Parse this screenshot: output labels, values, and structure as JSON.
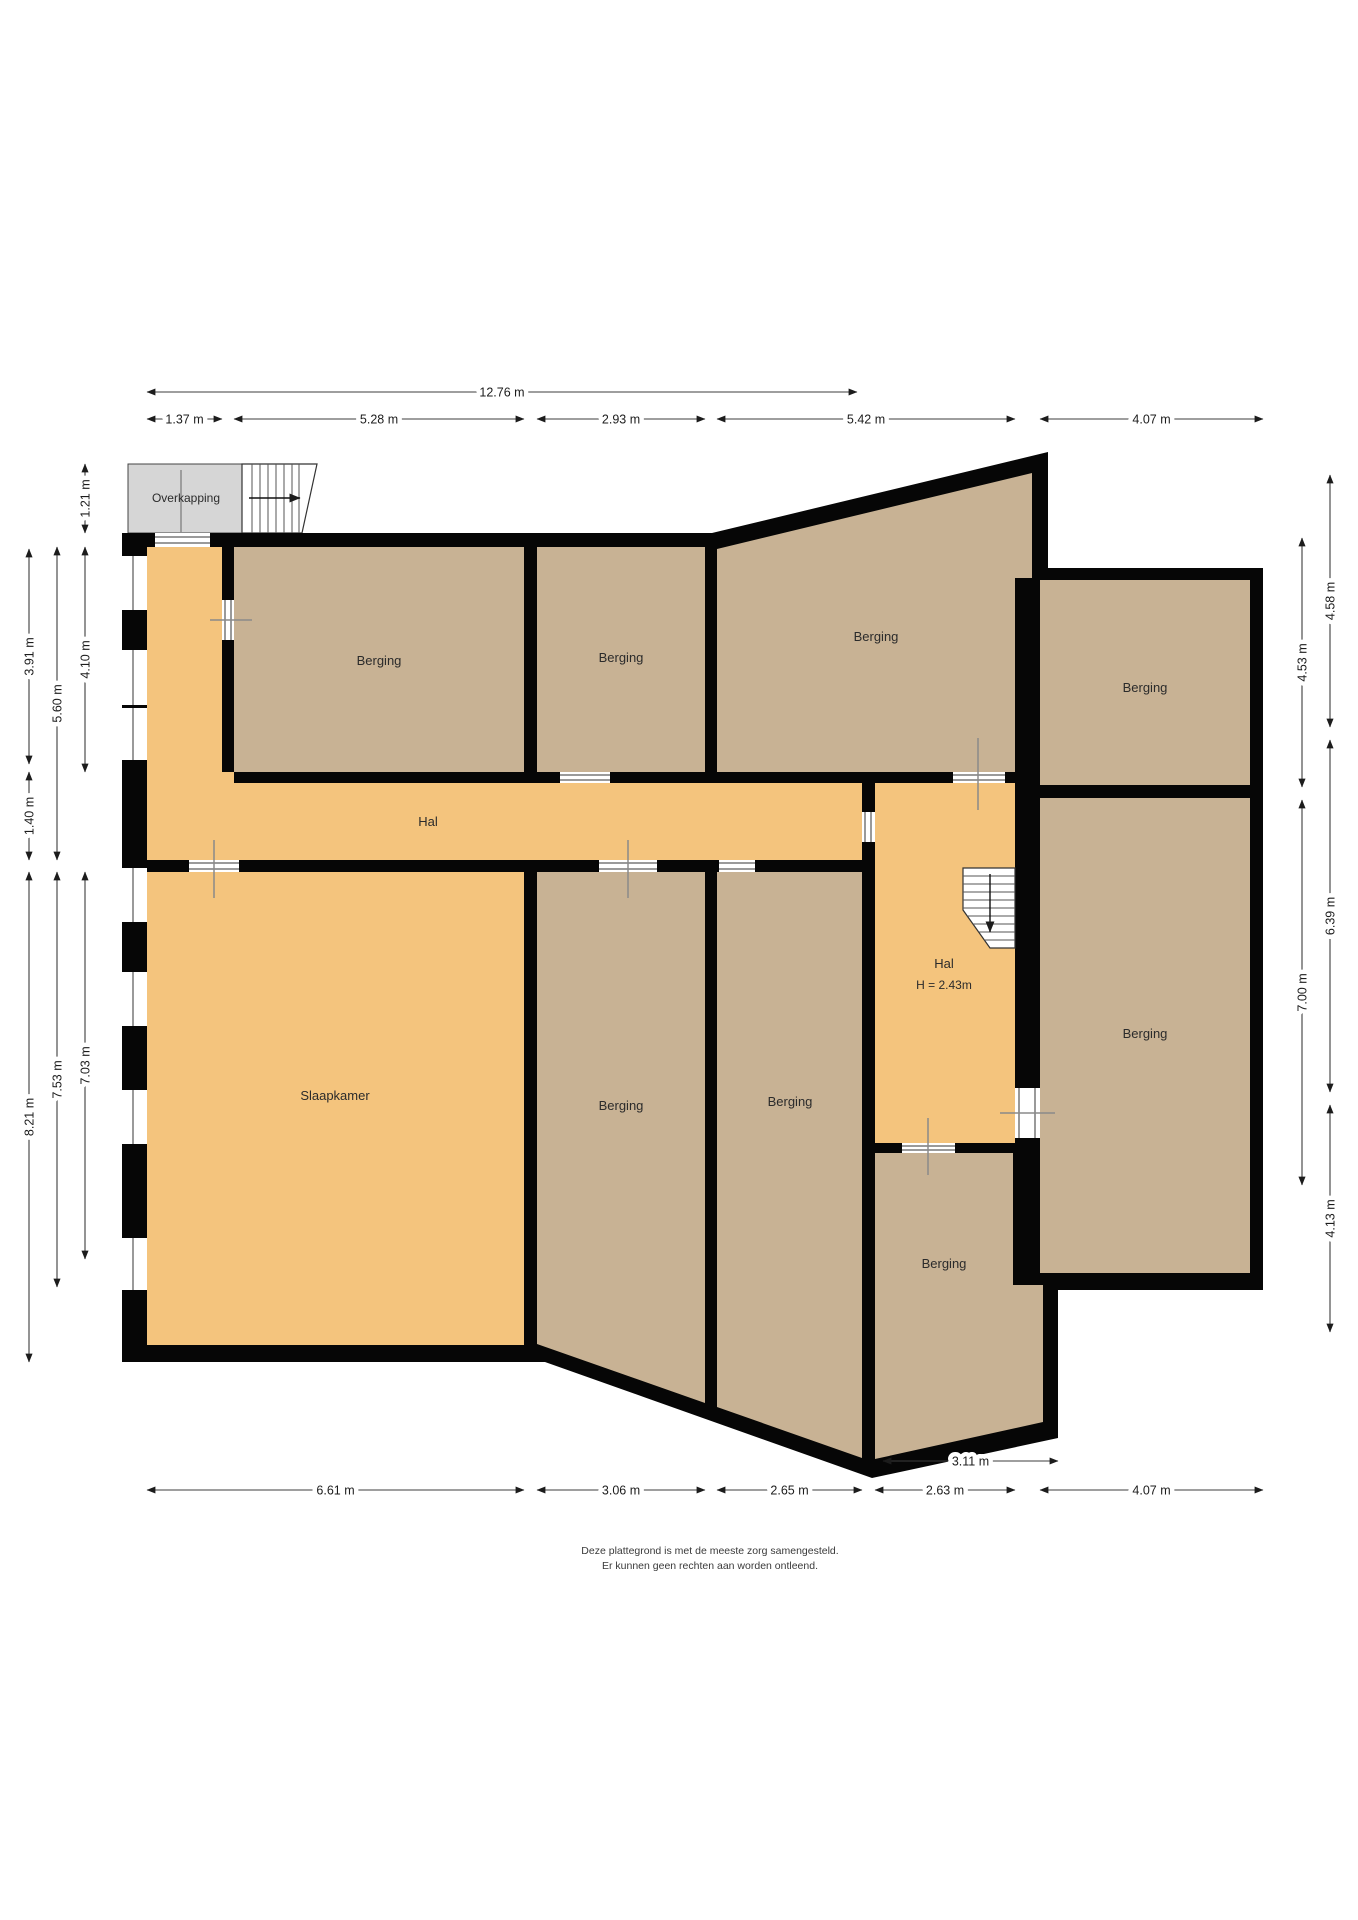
{
  "colors": {
    "wall": "#060606",
    "room_storage": "#c8b294",
    "room_hall": "#f4c47d",
    "canopy": "#d6d6d6",
    "dimension_text": "#1c1c1c"
  },
  "rooms": [
    {
      "id": "overkapping",
      "label": "Overkapping",
      "x": 186,
      "y": 502,
      "small": true
    },
    {
      "id": "berging-top-left",
      "label": "Berging",
      "x": 379,
      "y": 665
    },
    {
      "id": "berging-top-middle",
      "label": "Berging",
      "x": 621,
      "y": 662
    },
    {
      "id": "berging-top-right",
      "label": "Berging",
      "x": 876,
      "y": 641
    },
    {
      "id": "hal-corridor",
      "label": "Hal",
      "x": 428,
      "y": 826
    },
    {
      "id": "berging-wing-top",
      "label": "Berging",
      "x": 1145,
      "y": 692
    },
    {
      "id": "berging-wing-bottom",
      "label": "Berging",
      "x": 1145,
      "y": 1038
    },
    {
      "id": "hal-inner",
      "label": "Hal",
      "x": 944,
      "y": 968
    },
    {
      "id": "hal-inner-height",
      "label": "H = 2.43m",
      "x": 944,
      "y": 989,
      "small": true
    },
    {
      "id": "slaapkamer",
      "label": "Slaapkamer",
      "x": 335,
      "y": 1100
    },
    {
      "id": "berging-bottom-1",
      "label": "Berging",
      "x": 621,
      "y": 1110
    },
    {
      "id": "berging-bottom-2",
      "label": "Berging",
      "x": 790,
      "y": 1106
    },
    {
      "id": "berging-bottom-right",
      "label": "Berging",
      "x": 944,
      "y": 1268
    }
  ],
  "dimensions": {
    "top": [
      {
        "label": "12.76 m",
        "x1": 147,
        "x2": 857,
        "y": 392
      },
      {
        "label": "1.37 m",
        "x1": 147,
        "x2": 222,
        "y": 419
      },
      {
        "label": "5.28 m",
        "x1": 234,
        "x2": 524,
        "y": 419
      },
      {
        "label": "2.93 m",
        "x1": 537,
        "x2": 705,
        "y": 419
      },
      {
        "label": "5.42 m",
        "x1": 717,
        "x2": 1015,
        "y": 419
      },
      {
        "label": "4.07 m",
        "x1": 1040,
        "x2": 1263,
        "y": 419
      }
    ],
    "bottom": [
      {
        "label": "3.11 m",
        "x1": 883,
        "x2": 1058,
        "y": 1461
      },
      {
        "label": "6.61 m",
        "x1": 147,
        "x2": 524,
        "y": 1490
      },
      {
        "label": "3.06 m",
        "x1": 537,
        "x2": 705,
        "y": 1490
      },
      {
        "label": "2.65 m",
        "x1": 717,
        "x2": 862,
        "y": 1490
      },
      {
        "label": "2.63 m",
        "x1": 875,
        "x2": 1015,
        "y": 1490
      },
      {
        "label": "4.07 m",
        "x1": 1040,
        "x2": 1263,
        "y": 1490
      }
    ],
    "left": [
      {
        "label": "3.91 m",
        "y1": 549,
        "y2": 764,
        "x": 29
      },
      {
        "label": "1.40 m",
        "y1": 772,
        "y2": 860,
        "x": 29
      },
      {
        "label": "8.21 m",
        "y1": 872,
        "y2": 1362,
        "x": 29
      },
      {
        "label": "5.60 m",
        "y1": 547,
        "y2": 860,
        "x": 57
      },
      {
        "label": "7.53 m",
        "y1": 872,
        "y2": 1287,
        "x": 57
      },
      {
        "label": "1.21 m",
        "y1": 464,
        "y2": 533,
        "x": 85
      },
      {
        "label": "4.10 m",
        "y1": 547,
        "y2": 772,
        "x": 85
      },
      {
        "label": "7.03 m",
        "y1": 872,
        "y2": 1259,
        "x": 85
      }
    ],
    "right": [
      {
        "label": "4.58 m",
        "y1": 475,
        "y2": 727,
        "x": 1330
      },
      {
        "label": "6.39 m",
        "y1": 740,
        "y2": 1092,
        "x": 1330
      },
      {
        "label": "4.13 m",
        "y1": 1105,
        "y2": 1332,
        "x": 1330
      },
      {
        "label": "4.53 m",
        "y1": 538,
        "y2": 787,
        "x": 1302
      },
      {
        "label": "7.00 m",
        "y1": 800,
        "y2": 1185,
        "x": 1302
      }
    ]
  },
  "disclaimer": [
    "Deze plattegrond is met de meeste zorg samengesteld.",
    "Er kunnen geen rechten aan worden ontleend."
  ]
}
